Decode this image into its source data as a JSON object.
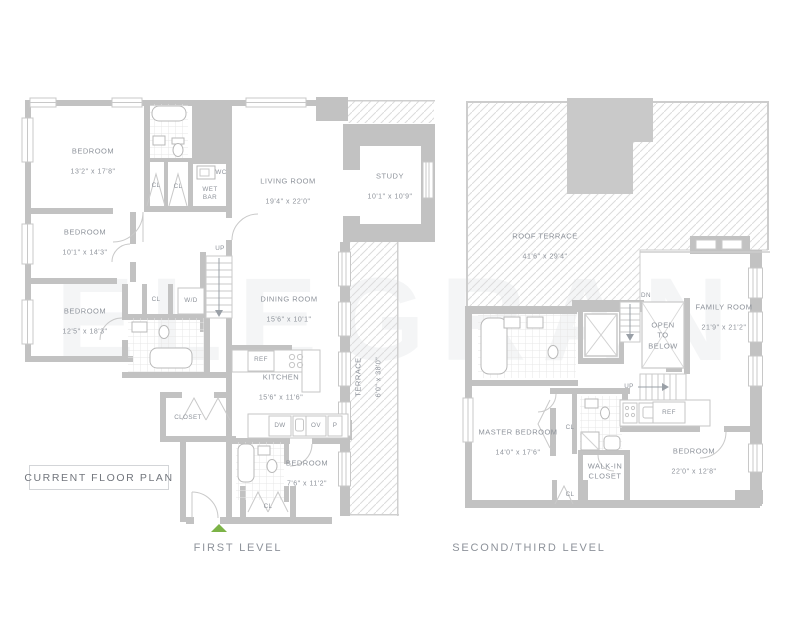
{
  "watermark": "ELEGRAN",
  "plan_badge": "CURRENT FLOOR PLAN",
  "entry_marker_color": "#7cb347",
  "levels": [
    {
      "caption": "FIRST LEVEL",
      "rooms": [
        {
          "name": "BEDROOM",
          "dims": "13'2\" x 17'8\""
        },
        {
          "name": "BEDROOM",
          "dims": "10'1\" x 14'3\""
        },
        {
          "name": "BEDROOM",
          "dims": "12'5\" x 18'3\""
        },
        {
          "name": "LIVING ROOM",
          "dims": "19'4\" x 22'0\""
        },
        {
          "name": "STUDY",
          "dims": "10'1\" x 10'9\""
        },
        {
          "name": "DINING ROOM",
          "dims": "15'6\" x 10'1\""
        },
        {
          "name": "KITCHEN",
          "dims": "15'6\" x 11'6\""
        },
        {
          "name": "BEDROOM",
          "dims": "7'6\" x 11'2\""
        },
        {
          "name": "TERRACE",
          "dims": "6'0\" x 38'0\""
        }
      ],
      "labels": {
        "wc": "WC",
        "wet_bar": "WET\nBAR",
        "cl": "CL",
        "up": "UP",
        "wd": "W/D",
        "closet": "CLOSET",
        "ref": "REF",
        "dw": "DW",
        "ov": "OV",
        "p": "P"
      }
    },
    {
      "caption": "SECOND/THIRD LEVEL",
      "rooms": [
        {
          "name": "ROOF TERRACE",
          "dims": "41'6\" x 29'4\""
        },
        {
          "name": "FAMILY ROOM",
          "dims": "21'9\" x 21'2\""
        },
        {
          "name": "MASTER BEDROOM",
          "dims": "14'0\" x 17'6\""
        },
        {
          "name": "BEDROOM",
          "dims": "22'0\" x 12'8\""
        },
        {
          "name": "OPEN\nTO\nBELOW",
          "dims": ""
        },
        {
          "name": "WALK-IN\nCLOSET",
          "dims": ""
        }
      ],
      "labels": {
        "dn": "DN",
        "up": "UP",
        "ref": "REF",
        "cl": "CL"
      }
    }
  ]
}
